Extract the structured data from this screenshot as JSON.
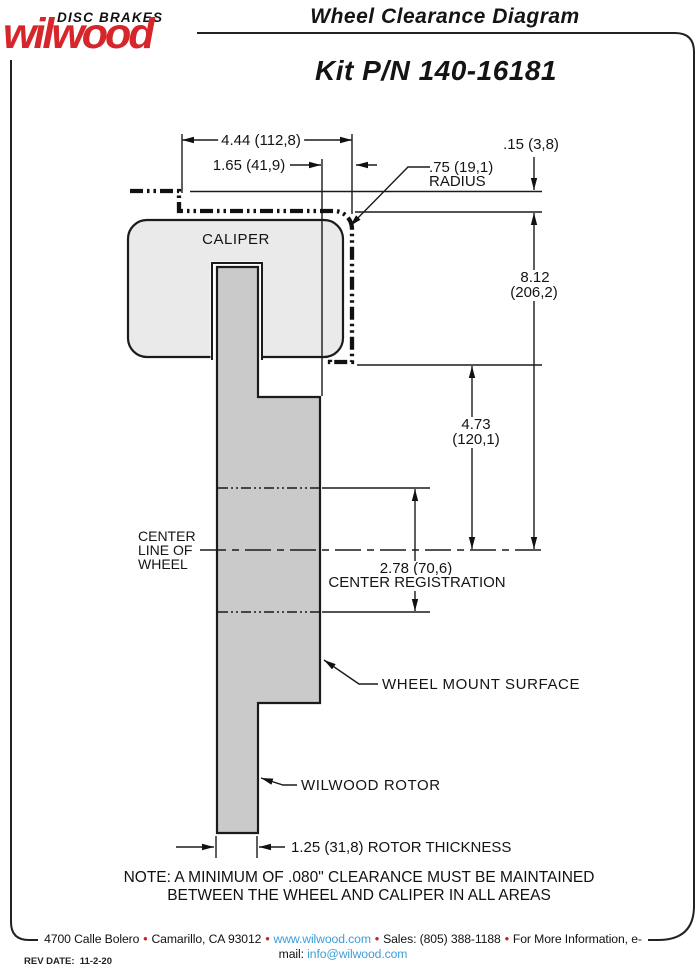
{
  "header": {
    "brand_top": "DISC BRAKES",
    "brand_name": "wilwood",
    "title": "Wheel Clearance Diagram",
    "kit": "Kit P/N 140-16181"
  },
  "diagram": {
    "caliper_label": "CALIPER",
    "centerline_label_1": "CENTER",
    "centerline_label_2": "LINE OF",
    "centerline_label_3": "WHEEL",
    "wheel_mount_label": "WHEEL MOUNT SURFACE",
    "rotor_label": "WILWOOD ROTOR",
    "dims": {
      "overall_width": "4.44 (112,8)",
      "rotor_to_mount": "1.65 (41,9)",
      "radius_value": ".75 (19,1)",
      "radius_word": "RADIUS",
      "top_clearance": ".15 (3,8)",
      "overall_height_in": "8.12",
      "overall_height_mm": "(206,2)",
      "mount_to_centerline_in": "4.73",
      "mount_to_centerline_mm": "(120,1)",
      "center_registration_value": "2.78 (70,6)",
      "center_registration_label": "CENTER REGISTRATION",
      "rotor_thickness": "1.25 (31,8) ROTOR THICKNESS"
    },
    "note_line1": "NOTE: A MINIMUM OF .080\" CLEARANCE MUST BE MAINTAINED",
    "note_line2": "BETWEEN THE WHEEL AND CALIPER IN ALL AREAS"
  },
  "footer": {
    "address": "4700 Calle Bolero",
    "city": "Camarillo, CA 93012",
    "website": "www.wilwood.com",
    "sales": "Sales: (805) 388-1188",
    "info_text": "For More Information, e-mail:",
    "email": "info@wilwood.com",
    "bullet": "•",
    "rev_date": "REV DATE:  11-2-20"
  },
  "colors": {
    "brand_red": "#d6252b",
    "link_blue": "#3d9ed8",
    "bullet_red": "#cc2127",
    "caliper_fill": "#eaeaea",
    "rotor_fill": "#cacaca",
    "line_color": "#1b1b1b"
  }
}
